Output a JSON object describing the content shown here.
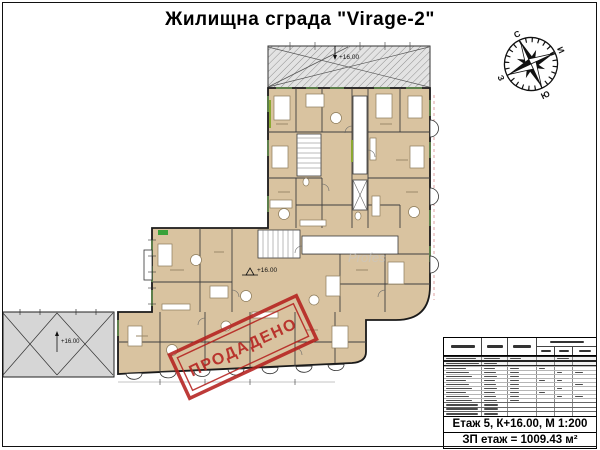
{
  "sheet": {
    "title": "Жилищна сграда \"Virage-2\""
  },
  "compass": {
    "n": "С",
    "e": "И",
    "s": "Ю",
    "w": "З"
  },
  "plan": {
    "sold_stamp": "ПРОДАДЕНО",
    "elevation_top": "+16.00",
    "elevation_mid": "+16.00",
    "elevation_roof": "+16.00",
    "watermark": "Profes"
  },
  "titleblock": {
    "scale_line": "Етаж 5, К+16.00, М 1:200",
    "area_line": "ЗП етаж = 1009.43 м²"
  },
  "colors": {
    "room_fill": "#d9c3a0",
    "stamp_red": "#b5211e",
    "roof_gray": "#d6d6d6",
    "window_green": "#5d7f4b"
  }
}
